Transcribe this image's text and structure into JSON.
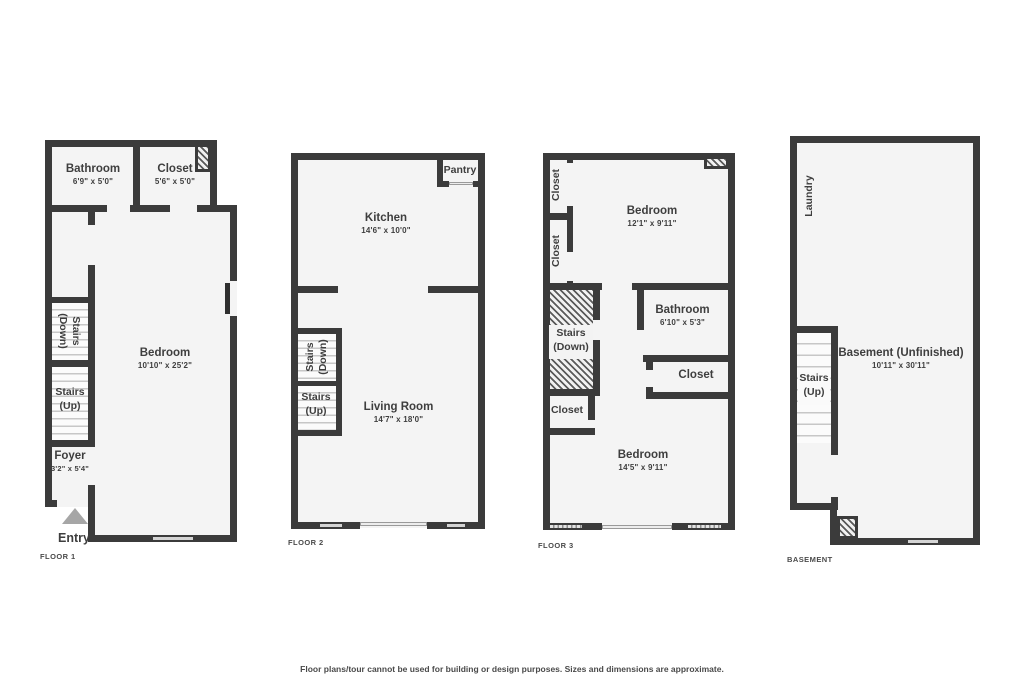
{
  "disclaimer": "Floor plans/tour cannot be used for building or design purposes. Sizes and dimensions are approximate.",
  "colors": {
    "wall": "#3b3b3b",
    "floor_fill": "#f4f4f4",
    "window_fill": "#d4d4d4",
    "entry_arrow": "#a6a6a6",
    "text": "#3e3e3e"
  },
  "icons": {
    "entry_icon": "arrow-up-triangle"
  },
  "floor1": {
    "caption": "FLOOR 1",
    "bathroom": {
      "name": "Bathroom",
      "dims": "6'9\" x 5'0\""
    },
    "closet": {
      "name": "Closet",
      "dims": "5'6\" x 5'0\""
    },
    "bedroom": {
      "name": "Bedroom",
      "dims": "10'10\" x 25'2\""
    },
    "stairs_down": {
      "line1": "Stairs",
      "line2": "(Down)"
    },
    "stairs_up": {
      "line1": "Stairs",
      "line2": "(Up)"
    },
    "foyer": {
      "name": "Foyer",
      "dims": "3'2\" x 5'4\""
    },
    "entry": "Entry"
  },
  "floor2": {
    "caption": "FLOOR 2",
    "pantry": {
      "name": "Pantry"
    },
    "kitchen": {
      "name": "Kitchen",
      "dims": "14'6\" x 10'0\""
    },
    "living_room": {
      "name": "Living Room",
      "dims": "14'7\" x 18'0\""
    },
    "stairs_down": {
      "line1": "Stairs",
      "line2": "(Down)"
    },
    "stairs_up": {
      "line1": "Stairs",
      "line2": "(Up)"
    }
  },
  "floor3": {
    "caption": "FLOOR 3",
    "closet_top": {
      "name": "Closet"
    },
    "closet_mid": {
      "name": "Closet"
    },
    "bedroom_top": {
      "name": "Bedroom",
      "dims": "12'1\" x 9'11\""
    },
    "bathroom": {
      "name": "Bathroom",
      "dims": "6'10\" x 5'3\""
    },
    "closet_right": {
      "name": "Closet"
    },
    "closet_left": {
      "name": "Closet"
    },
    "stairs_down": {
      "line1": "Stairs",
      "line2": "(Down)"
    },
    "bedroom_bottom": {
      "name": "Bedroom",
      "dims": "14'5\" x 9'11\""
    }
  },
  "basement": {
    "caption": "BASEMENT",
    "laundry": "Laundry",
    "stairs_up": {
      "line1": "Stairs",
      "line2": "(Up)"
    },
    "room": {
      "name": "Basement (Unfinished)",
      "dims": "10'11\" x 30'11\""
    }
  }
}
